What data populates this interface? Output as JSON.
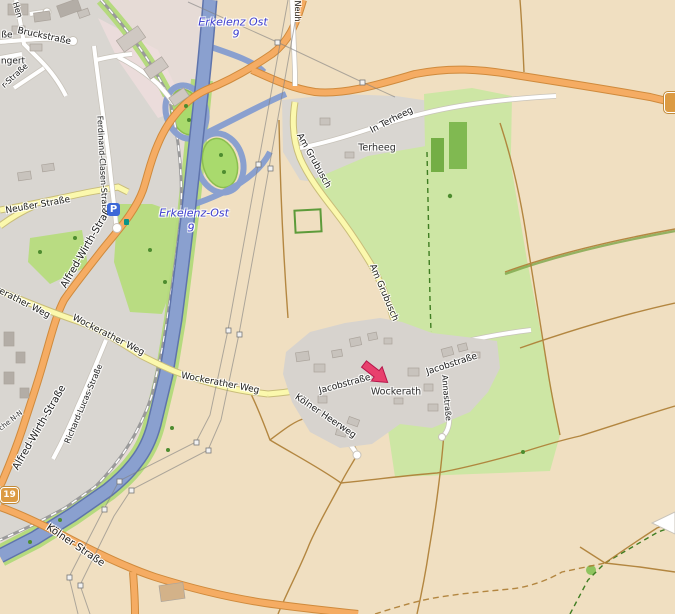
{
  "map_title": "OpenStreetMap view of Wockerath / Terheeg near Erkelenz with location arrow",
  "labels": {
    "hen": "Hen",
    "sse": "ße",
    "bruckstrasse": "Bruckstraße",
    "ngert": "ngert",
    "r_strasse": "r-Straße",
    "erkelenz_ost_top": "Erkelenz Ost",
    "nine_top": "9",
    "neuh": "Neuh",
    "in_terheeg": "In Terheeg",
    "terheeg": "Terheeg",
    "am_grubusch_1": "Am Grubusch",
    "am_grubusch_2": "Am Grubusch",
    "erkelenz_ost_2": "Erkelenz-Ost",
    "nine_2": "9",
    "neusser_strasse": "Neußer Straße",
    "ferdinand": "Ferdinand-Clasen-Straße",
    "alfred_1": "Alfred-Wirth-Straße",
    "alfred_2": "Alfred-Wirth-Straße",
    "kerather_weg": "kerather Weg",
    "wockerather_1": "Wockerather Weg",
    "wockerather_2": "Wockerather Weg",
    "richard": "Richard-Lucas-Straße",
    "che_nn": "che N-N",
    "koelner_strasse": "Kölner Straße",
    "jacobstrasse_1": "Jacobstraße",
    "wockerath": "Wockerath",
    "jacobstrasse_2": "Jacobstraße",
    "annastrasse": "Annastraße",
    "koelner_heerweg": "Kölner Heerweg"
  },
  "route_shield": "19",
  "parking_icon": "P",
  "marker": {
    "type": "red-arrow",
    "points_at": "Wockerath",
    "color": "#e8406d"
  },
  "colors": {
    "farmland": "#f0dfc1",
    "urban": "#d9d6d1",
    "industrial": "#e6dbd6",
    "meadow": "#cde6a4",
    "loop_green": "#a9da6d",
    "forest": "#74ae45",
    "motorway": "#8aa0cf",
    "secondary_road": "#f5ac63",
    "tertiary_road": "#fbf8ad",
    "minor_road": "#ffffff",
    "track": "#ad7d33",
    "boundary": "#3f7d22",
    "junction_label": "#3c3ccf",
    "marker_red": "#e8406d",
    "shield_bg": "#dc9b43"
  }
}
